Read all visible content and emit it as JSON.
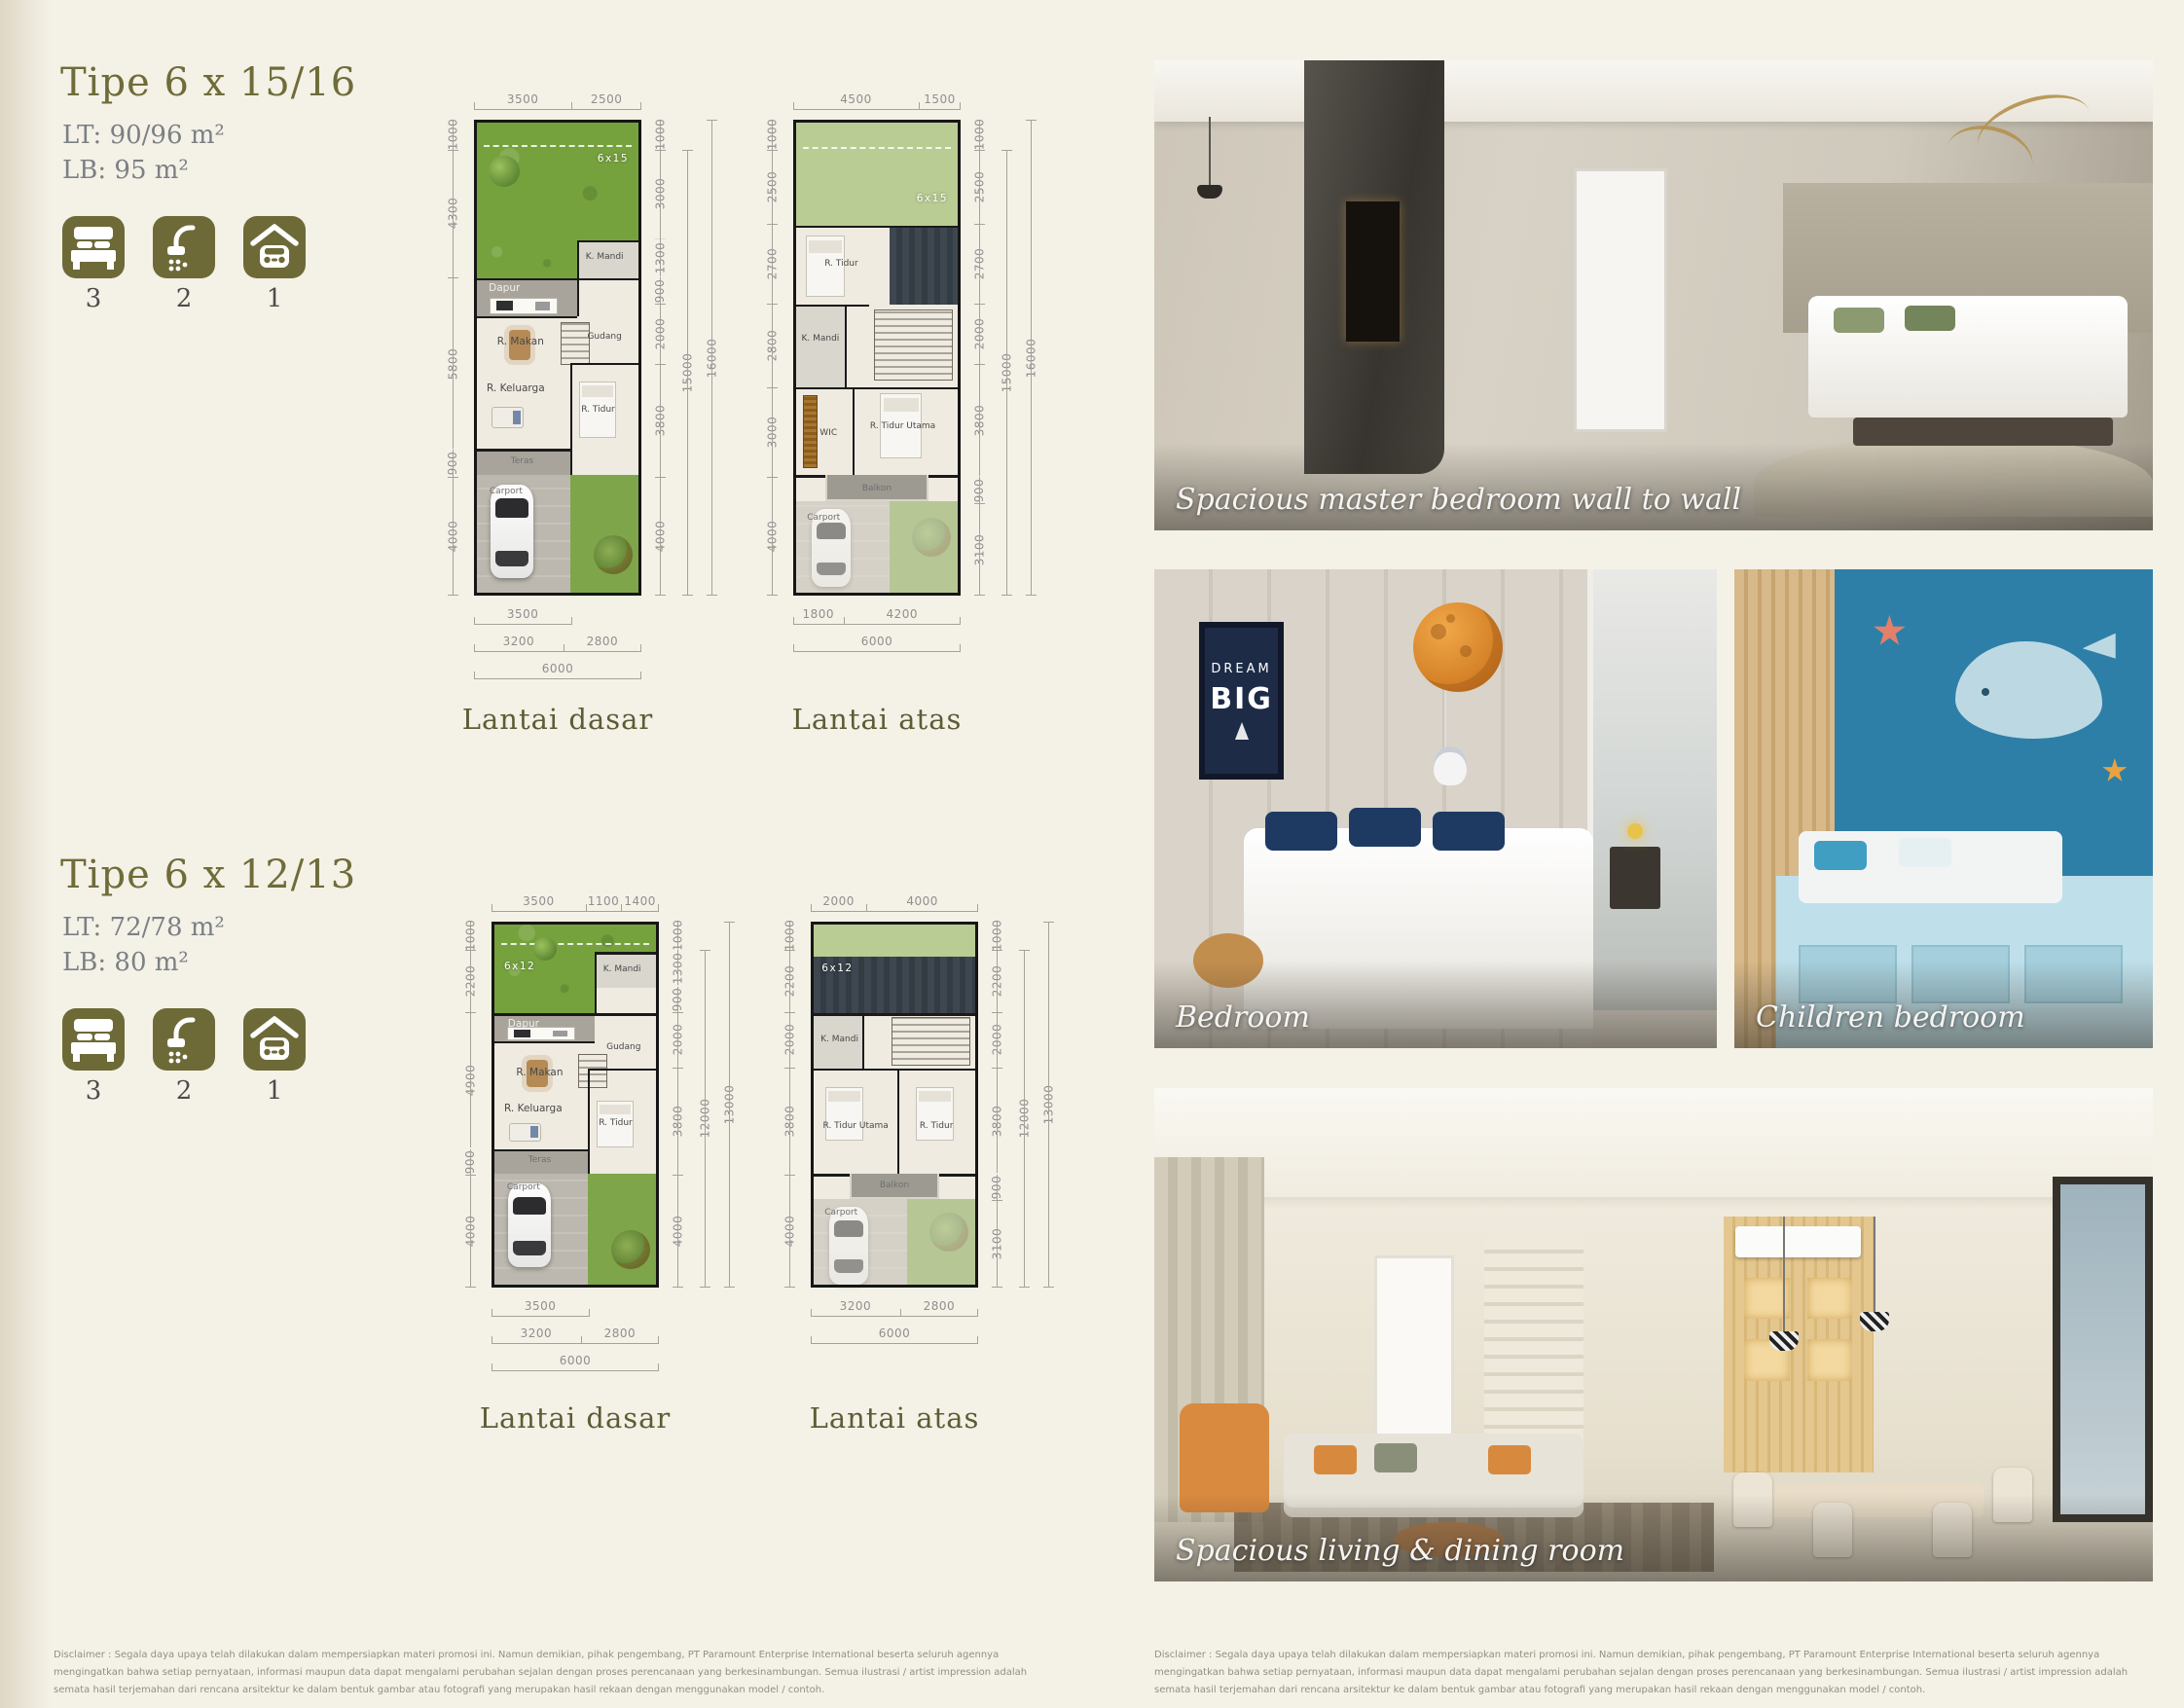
{
  "colors": {
    "accent": "#6d6a38",
    "background": "#f4f1e7",
    "title": "#6f6c39",
    "dim_text": "#8f8f8f",
    "caption_text": "#f4f4f2"
  },
  "types": [
    {
      "title": "Tipe 6 x 15/16",
      "lt": "LT: 90/96 m²",
      "lb": "LB: 95 m²",
      "stats": {
        "beds": "3",
        "baths": "2",
        "carports": "1"
      },
      "floors": [
        {
          "caption": "Lantai dasar",
          "badge": "6x15",
          "top": [
            "3500",
            "2500"
          ],
          "left": [
            "1000",
            "4300",
            "5800",
            "900",
            "4000"
          ],
          "right": [
            "1000",
            "3000",
            "1300",
            "900",
            "2000",
            "3800",
            "4000"
          ],
          "outer": [
            "15000",
            "16000"
          ],
          "b1": [
            "3500"
          ],
          "b2": [
            "3200",
            "2800"
          ],
          "total": "6000",
          "rooms": {
            "dapur": "Dapur",
            "kmandi": "K. Mandi",
            "makan": "R. Makan",
            "gudang": "Gudang",
            "keluarga": "R. Keluarga",
            "tidur": "R. Tidur",
            "teras": "Teras",
            "carport": "Carport"
          }
        },
        {
          "caption": "Lantai atas",
          "badge": "6x15",
          "top": [
            "4500",
            "1500"
          ],
          "left": [
            "1000",
            "2500",
            "2700",
            "2800",
            "3000",
            "4000"
          ],
          "right": [
            "1000",
            "2500",
            "2700",
            "2000",
            "3800",
            "900",
            "3100"
          ],
          "outer": [
            "15000",
            "16000"
          ],
          "b1": [
            "1800",
            "4200"
          ],
          "total": "6000",
          "rooms": {
            "tidur": "R. Tidur",
            "kmandi": "K. Mandi",
            "wic": "WIC",
            "utama": "R. Tidur Utama",
            "balkon": "Balkon",
            "carport": "Carport"
          }
        }
      ]
    },
    {
      "title": "Tipe 6 x 12/13",
      "lt": "LT: 72/78 m²",
      "lb": "LB: 80 m²",
      "stats": {
        "beds": "3",
        "baths": "2",
        "carports": "1"
      },
      "floors": [
        {
          "caption": "Lantai dasar",
          "badge": "6x12",
          "top": [
            "3500",
            "1100",
            "1400"
          ],
          "left": [
            "1000",
            "2200",
            "4900",
            "900",
            "4000"
          ],
          "right": [
            "1000",
            "1300",
            "900",
            "2000",
            "3800",
            "4000"
          ],
          "outer": [
            "12000",
            "13000"
          ],
          "b1": [
            "3500"
          ],
          "b2": [
            "3200",
            "2800"
          ],
          "total": "6000",
          "rooms": {
            "dapur": "Dapur",
            "kmandi": "K. Mandi",
            "makan": "R. Makan",
            "gudang": "Gudang",
            "keluarga": "R. Keluarga",
            "tidur": "R. Tidur",
            "teras": "Teras",
            "carport": "Carport"
          }
        },
        {
          "caption": "Lantai atas",
          "badge": "6x12",
          "top": [
            "2000",
            "4000"
          ],
          "left": [
            "1000",
            "2200",
            "2000",
            "3800",
            "4000"
          ],
          "right": [
            "1000",
            "2200",
            "2000",
            "3800",
            "900",
            "3100"
          ],
          "outer": [
            "12000",
            "13000"
          ],
          "b2": [
            "3200",
            "2800"
          ],
          "total": "6000",
          "rooms": {
            "kmandi": "K. Mandi",
            "utama": "R. Tidur Utama",
            "tidur": "R. Tidur",
            "balkon": "Balkon",
            "carport": "Carport"
          }
        }
      ]
    }
  ],
  "photos": [
    {
      "caption": "Spacious master bedroom wall to wall"
    },
    {
      "caption": "Bedroom",
      "poster_line1": "DREAM",
      "poster_line2": "BIG"
    },
    {
      "caption": "Children bedroom"
    },
    {
      "caption": "Spacious living & dining room"
    }
  ],
  "disclaimer": "Disclaimer : Segala daya upaya telah dilakukan dalam mempersiapkan materi promosi ini. Namun demikian, pihak pengembang, PT Paramount Enterprise International beserta seluruh agennya mengingatkan bahwa setiap pernyataan, informasi maupun data dapat mengalami perubahan sejalan dengan proses perencanaan yang berkesinambungan. Semua ilustrasi / artist impression adalah semata hasil terjemahan  dari rencana arsitektur ke dalam bentuk gambar atau fotografi yang merupakan hasil rekaan dengan menggunakan model / contoh."
}
